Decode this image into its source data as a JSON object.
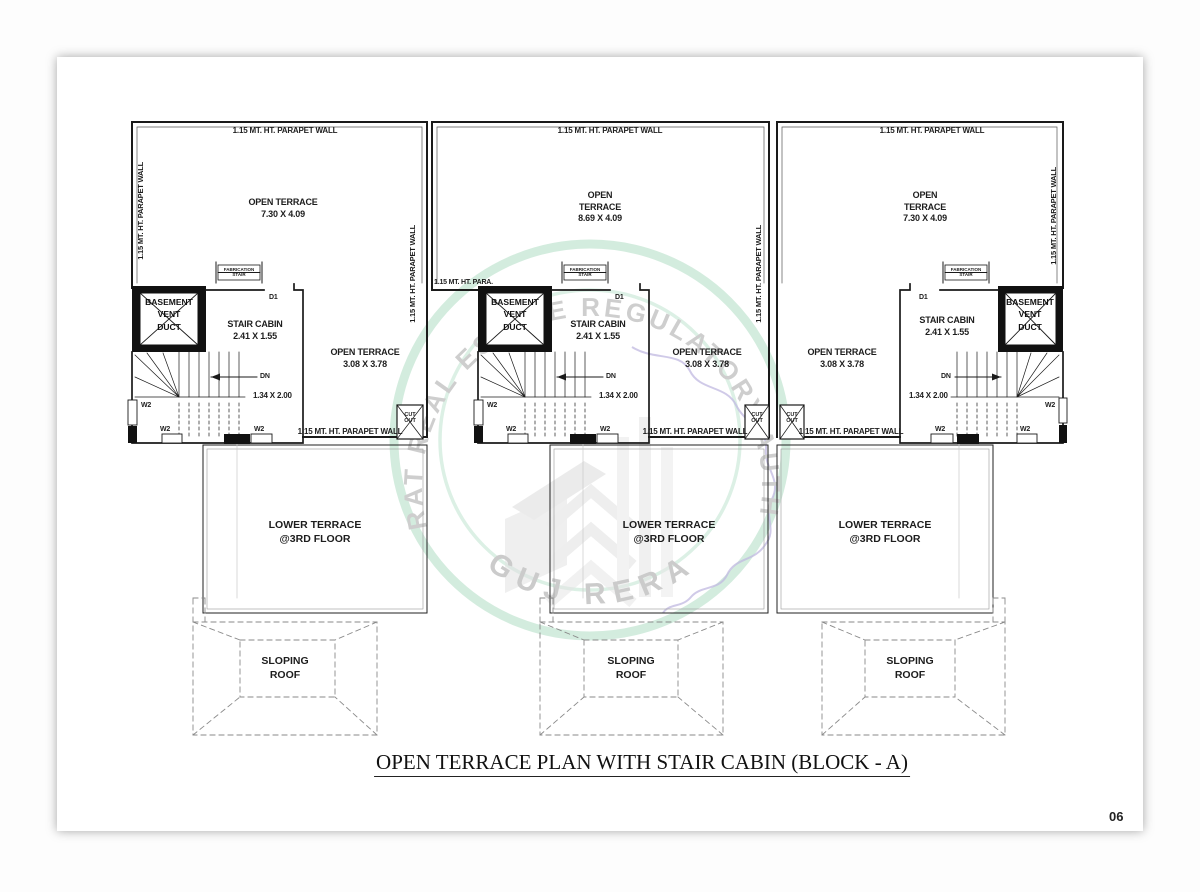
{
  "sheet": {
    "title": "OPEN TERRACE PLAN WITH STAIR CABIN (BLOCK - A)",
    "page_number": "06"
  },
  "watermark": {
    "arc_text": "GUJARAT REAL ESTATE REGULATORY AUTHORITY",
    "bottom_text": "GUJ RERA",
    "ring_color": "#cfeadb",
    "text_color": "#c9c9c9",
    "map_color": "#b9b2de"
  },
  "labels": {
    "parapet_wall": "1.15 MT. HT. PARAPET WALL",
    "parapet_wall_short": "1.15 MT. HT. PARA.",
    "open": "OPEN",
    "terrace": "TERRACE",
    "open_terrace": "OPEN TERRACE",
    "stair_cabin": "STAIR CABIN",
    "stair_cabin_dim": "2.41 X 1.55",
    "side_terrace_dim": "3.08 X 3.78",
    "stair_dim": "1.34 X 2.00",
    "basement_line1": "BASEMENT",
    "basement_line2": "VENT",
    "basement_line3": "DUCT",
    "fabrication_line1": "FABRICATION",
    "fabrication_line2": "STAIR",
    "cutout_line1": "CUT",
    "cutout_line2": "OUT",
    "door": "D1",
    "window": "W2",
    "down": "DN",
    "lower_terrace": "LOWER TERRACE",
    "lower_terrace_floor": "@3RD FLOOR",
    "sloping": "SLOPING",
    "roof": "ROOF"
  },
  "units": [
    {
      "id": "unit-1",
      "main_terrace_dim": "7.30 X 4.09"
    },
    {
      "id": "unit-2",
      "main_terrace_dim": "8.69 X 4.09"
    },
    {
      "id": "unit-3",
      "main_terrace_dim": "7.30 X 4.09"
    }
  ]
}
